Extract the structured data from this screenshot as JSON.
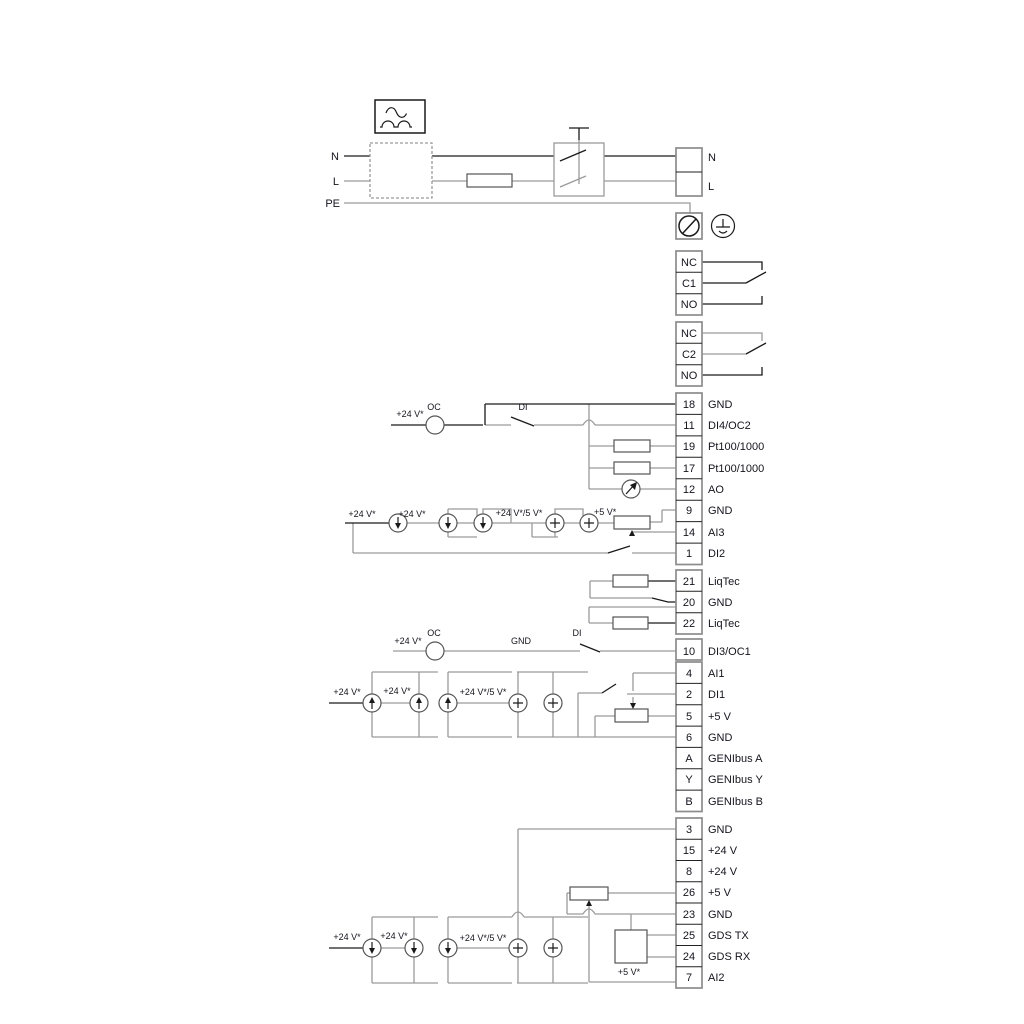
{
  "power": {
    "n": "N",
    "l": "L",
    "pe": "PE"
  },
  "relay1": [
    "NC",
    "C1",
    "NO"
  ],
  "relay2": [
    "NC",
    "C2",
    "NO"
  ],
  "s1": [
    {
      "id": "18",
      "label": "GND"
    },
    {
      "id": "11",
      "label": "DI4/OC2"
    },
    {
      "id": "19",
      "label": "Pt100/1000"
    },
    {
      "id": "17",
      "label": "Pt100/1000"
    },
    {
      "id": "12",
      "label": "AO"
    },
    {
      "id": "9",
      "label": "GND"
    },
    {
      "id": "14",
      "label": "AI3"
    },
    {
      "id": "1",
      "label": "DI2"
    }
  ],
  "s2": [
    {
      "id": "21",
      "label": "LiqTec"
    },
    {
      "id": "20",
      "label": "GND"
    },
    {
      "id": "22",
      "label": "LiqTec"
    }
  ],
  "s3": [
    {
      "id": "10",
      "label": "DI3/OC1"
    },
    {
      "id": "4",
      "label": "AI1"
    },
    {
      "id": "2",
      "label": "DI1"
    },
    {
      "id": "5",
      "label": "+5 V"
    },
    {
      "id": "6",
      "label": "GND"
    },
    {
      "id": "A",
      "label": "GENIbus A"
    },
    {
      "id": "Y",
      "label": "GENIbus Y"
    },
    {
      "id": "B",
      "label": "GENIbus B"
    }
  ],
  "s4": [
    {
      "id": "3",
      "label": "GND"
    },
    {
      "id": "15",
      "label": "+24 V"
    },
    {
      "id": "8",
      "label": "+24 V"
    },
    {
      "id": "26",
      "label": "+5 V"
    },
    {
      "id": "23",
      "label": "GND"
    },
    {
      "id": "25",
      "label": "GDS TX"
    },
    {
      "id": "24",
      "label": "GDS RX"
    },
    {
      "id": "7",
      "label": "AI2"
    }
  ],
  "wire": {
    "v24": "+24 V*",
    "v24v5": "+24 V*/5 V*",
    "v5": "+5 V*",
    "oc": "OC",
    "di": "DI",
    "gnd": "GND"
  },
  "colors": {
    "wire_gray": "#9a9a9a",
    "wire_black": "#1a1a1a",
    "box_stroke": "#8c8c8c",
    "text": "#14141e"
  }
}
